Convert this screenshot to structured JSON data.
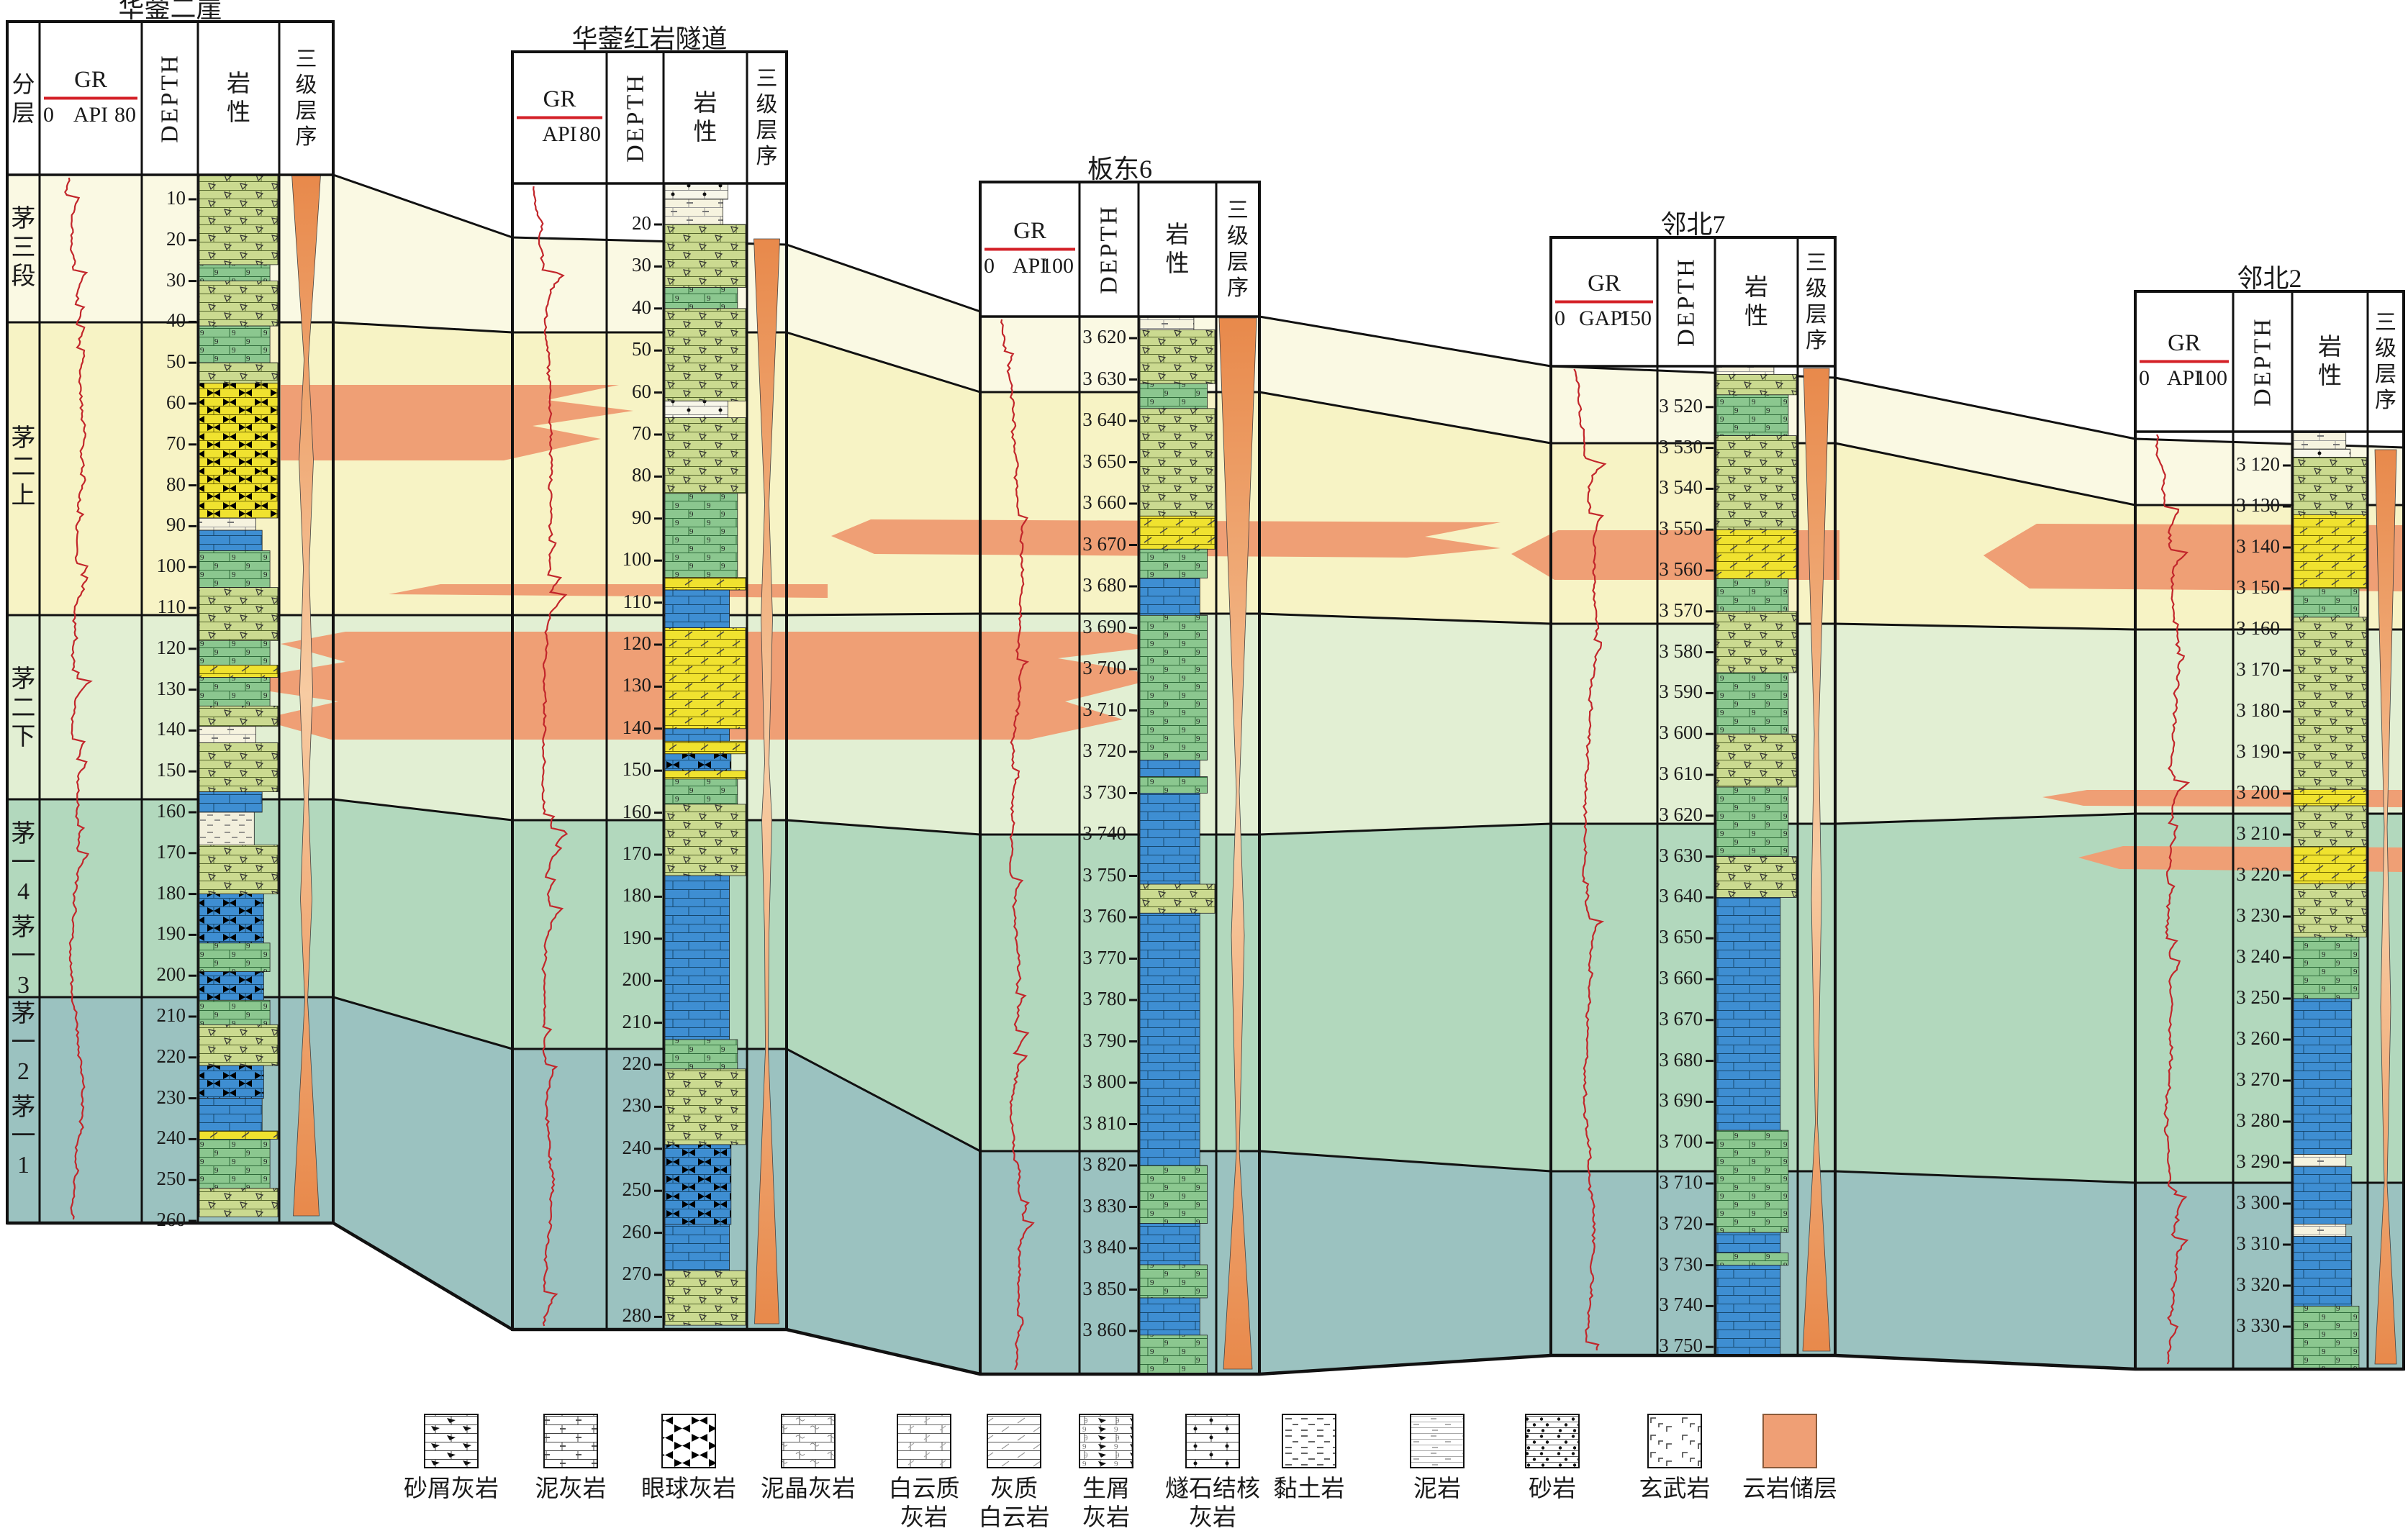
{
  "section": {
    "wells": [
      {
        "title": "华蓥二崖",
        "fenceng_label": "分层",
        "gr": {
          "label": "GR",
          "min": "0",
          "unit": "API",
          "max": "80"
        },
        "depth_label": "DEPTH",
        "lith_label": "岩性",
        "seq_label": "三级层序",
        "ticks": [
          "10",
          "20",
          "30",
          "40",
          "50",
          "60",
          "70",
          "80",
          "90",
          "100",
          "110",
          "120",
          "130",
          "140",
          "150",
          "160",
          "170",
          "180",
          "190",
          "200",
          "210",
          "220",
          "230",
          "240",
          "250",
          "260"
        ],
        "lithology": [
          [
            4,
            26,
            "bs"
          ],
          [
            26,
            30,
            "bn"
          ],
          [
            30,
            41,
            "bs"
          ],
          [
            41,
            50,
            "bn"
          ],
          [
            50,
            55,
            "bs"
          ],
          [
            55,
            88,
            "ey"
          ],
          [
            88,
            91,
            "ma"
          ],
          [
            91,
            96,
            "ls"
          ],
          [
            96,
            105,
            "bn"
          ],
          [
            105,
            118,
            "bs"
          ],
          [
            118,
            124,
            "bn"
          ],
          [
            124,
            127,
            "do"
          ],
          [
            127,
            134,
            "bn"
          ],
          [
            134,
            139,
            "bs"
          ],
          [
            139,
            143,
            "ma"
          ],
          [
            143,
            155,
            "bs"
          ],
          [
            155,
            160,
            "ls"
          ],
          [
            160,
            168,
            "cl"
          ],
          [
            168,
            180,
            "bs"
          ],
          [
            180,
            192,
            "eb"
          ],
          [
            192,
            199,
            "bn"
          ],
          [
            199,
            206,
            "eb"
          ],
          [
            206,
            212,
            "bn"
          ],
          [
            212,
            222,
            "bs"
          ],
          [
            222,
            230,
            "eb"
          ],
          [
            230,
            238,
            "ls"
          ],
          [
            238,
            240,
            "do"
          ],
          [
            240,
            252,
            "bn"
          ],
          [
            252,
            259,
            "bs"
          ]
        ]
      },
      {
        "title": "华蓥红岩隧道",
        "gr": {
          "label": "GR",
          "min": "",
          "unit": "API",
          "max": "80"
        },
        "depth_label": "DEPTH",
        "lith_label": "岩性",
        "seq_label": "三级层序",
        "ticks": [
          "20",
          "30",
          "40",
          "50",
          "60",
          "70",
          "80",
          "90",
          "100",
          "110",
          "120",
          "130",
          "140",
          "150",
          "160",
          "170",
          "180",
          "190",
          "200",
          "210",
          "220",
          "230",
          "240",
          "250",
          "260",
          "270",
          "280"
        ],
        "lithology": [
          [
            10,
            14,
            "ch"
          ],
          [
            14,
            20,
            "ma"
          ],
          [
            20,
            35,
            "bs"
          ],
          [
            35,
            40,
            "bn"
          ],
          [
            40,
            62,
            "bs"
          ],
          [
            62,
            66,
            "ch"
          ],
          [
            66,
            84,
            "bs"
          ],
          [
            84,
            104,
            "bn"
          ],
          [
            104,
            107,
            "do"
          ],
          [
            107,
            116,
            "ls"
          ],
          [
            116,
            140,
            "do"
          ],
          [
            140,
            143,
            "ls"
          ],
          [
            143,
            146,
            "do"
          ],
          [
            146,
            150,
            "eb"
          ],
          [
            150,
            152,
            "do"
          ],
          [
            152,
            158,
            "bn"
          ],
          [
            158,
            175,
            "bs"
          ],
          [
            175,
            214,
            "ls"
          ],
          [
            214,
            221,
            "bn"
          ],
          [
            221,
            239,
            "bs"
          ],
          [
            239,
            258,
            "eb"
          ],
          [
            258,
            269,
            "ls"
          ],
          [
            269,
            282,
            "bs"
          ]
        ]
      },
      {
        "title": "板东6",
        "gr": {
          "label": "GR",
          "min": "0",
          "unit": "API",
          "max": "100"
        },
        "depth_label": "DEPTH",
        "lith_label": "岩性",
        "seq_label": "三级层序",
        "ticks": [
          "3 620",
          "3 630",
          "3 640",
          "3 650",
          "3 660",
          "3 670",
          "3 680",
          "3 690",
          "3 700",
          "3 710",
          "3 720",
          "3 730",
          "3 740",
          "3 750",
          "3 760",
          "3 770",
          "3 780",
          "3 790",
          "3 800",
          "3 810",
          "3 820",
          "3 830",
          "3 840",
          "3 850",
          "3 860",
          "3 870"
        ],
        "lithology": [
          [
            3615,
            3618,
            "ma"
          ],
          [
            3618,
            3631,
            "bs"
          ],
          [
            3631,
            3637,
            "bn"
          ],
          [
            3637,
            3663,
            "bs"
          ],
          [
            3663,
            3671,
            "do"
          ],
          [
            3671,
            3678,
            "bn"
          ],
          [
            3678,
            3687,
            "ls"
          ],
          [
            3687,
            3722,
            "bn"
          ],
          [
            3722,
            3726,
            "ls"
          ],
          [
            3726,
            3730,
            "bn"
          ],
          [
            3730,
            3752,
            "ls"
          ],
          [
            3752,
            3759,
            "bs"
          ],
          [
            3759,
            3820,
            "ls"
          ],
          [
            3820,
            3834,
            "bn"
          ],
          [
            3834,
            3844,
            "ls"
          ],
          [
            3844,
            3852,
            "bn"
          ],
          [
            3852,
            3861,
            "ls"
          ],
          [
            3861,
            3871,
            "bn"
          ]
        ]
      },
      {
        "title": "邻北7",
        "gr": {
          "label": "GR",
          "min": "0",
          "unit": "GAPI",
          "max": "150"
        },
        "depth_label": "DEPTH",
        "lith_label": "岩性",
        "seq_label": "三级层序",
        "ticks": [
          "3 510",
          "3 520",
          "3 530",
          "3 540",
          "3 550",
          "3 560",
          "3 570",
          "3 580",
          "3 590",
          "3 600",
          "3 610",
          "3 620",
          "3 630",
          "3 640",
          "3 650",
          "3 660",
          "3 670",
          "3 680",
          "3 690",
          "3 700",
          "3 710",
          "3 720",
          "3 730",
          "3 740",
          "3 750"
        ],
        "lithology": [
          [
            3510,
            3512,
            "ma"
          ],
          [
            3512,
            3517,
            "bs"
          ],
          [
            3517,
            3527,
            "bn"
          ],
          [
            3527,
            3550,
            "bs"
          ],
          [
            3550,
            3562,
            "do"
          ],
          [
            3562,
            3570,
            "bn"
          ],
          [
            3570,
            3585,
            "bs"
          ],
          [
            3585,
            3600,
            "bn"
          ],
          [
            3600,
            3613,
            "bs"
          ],
          [
            3613,
            3630,
            "bn"
          ],
          [
            3630,
            3640,
            "bs"
          ],
          [
            3640,
            3697,
            "ls"
          ],
          [
            3697,
            3722,
            "bn"
          ],
          [
            3722,
            3727,
            "ls"
          ],
          [
            3727,
            3730,
            "bn"
          ],
          [
            3730,
            3752,
            "ls"
          ]
        ]
      },
      {
        "title": "邻北2",
        "gr": {
          "label": "GR",
          "min": "0",
          "unit": "API",
          "max": "100"
        },
        "depth_label": "DEPTH",
        "lith_label": "岩性",
        "seq_label": "三级层序",
        "ticks": [
          "3 120",
          "3 130",
          "3 140",
          "3 150",
          "3 160",
          "3 170",
          "3 180",
          "3 190",
          "3 200",
          "3 210",
          "3 220",
          "3 230",
          "3 240",
          "3 250",
          "3 260",
          "3 270",
          "3 280",
          "3 290",
          "3 300",
          "3 310",
          "3 320",
          "3 330",
          "3 340"
        ],
        "lithology": [
          [
            3112,
            3116,
            "ma"
          ],
          [
            3116,
            3118,
            "ch"
          ],
          [
            3118,
            3132,
            "bs"
          ],
          [
            3132,
            3150,
            "do"
          ],
          [
            3150,
            3157,
            "bn"
          ],
          [
            3157,
            3199,
            "bs"
          ],
          [
            3199,
            3203,
            "do"
          ],
          [
            3203,
            3213,
            "bs"
          ],
          [
            3213,
            3222,
            "do"
          ],
          [
            3222,
            3235,
            "bs"
          ],
          [
            3235,
            3250,
            "bn"
          ],
          [
            3250,
            3288,
            "ls"
          ],
          [
            3288,
            3291,
            "ma"
          ],
          [
            3291,
            3305,
            "ls"
          ],
          [
            3305,
            3308,
            "ma"
          ],
          [
            3308,
            3325,
            "ls"
          ],
          [
            3325,
            3341,
            "bn"
          ]
        ]
      }
    ],
    "fenceng_zones": [
      {
        "label": "茅三段"
      },
      {
        "label": "茅二上"
      },
      {
        "label": "茅二下"
      },
      {
        "label": "茅一4"
      },
      {
        "label": "茅一3"
      },
      {
        "label": "茅一2"
      },
      {
        "label": "茅一1"
      }
    ],
    "legend": [
      {
        "label": "砂屑灰岩",
        "pattern": "sandclast"
      },
      {
        "label": "泥灰岩",
        "pattern": "marl"
      },
      {
        "label": "眼球灰岩",
        "pattern": "eyeball"
      },
      {
        "label": "泥晶灰岩",
        "pattern": "micrite"
      },
      {
        "label": "白云质\n灰岩",
        "pattern": "dololime"
      },
      {
        "label": "灰质\n白云岩",
        "pattern": "limydolo"
      },
      {
        "label": "生屑\n灰岩",
        "pattern": "bioclast"
      },
      {
        "label": "燧石结核\n灰岩",
        "pattern": "chert"
      },
      {
        "label": "黏土岩",
        "pattern": "clay"
      },
      {
        "label": "泥岩",
        "pattern": "mud"
      },
      {
        "label": "砂岩",
        "pattern": "sand"
      },
      {
        "label": "玄武岩",
        "pattern": "basalt"
      },
      {
        "label": "云岩储层",
        "pattern": "reservoir"
      }
    ],
    "colors": {
      "zone_m3": "#FAF9E3",
      "zone_m2_upper": "#F7F3C5",
      "zone_m2_lower": "#E2EFD3",
      "zone_m1_upper": "#B2D8BD",
      "zone_m1_lower": "#9BC2C0",
      "reservoir": "#EF9F75",
      "gr_curve": "#C2262B",
      "scale_line": "#D42027",
      "lith_olive": "#CBDA90",
      "lith_green": "#8BC78F",
      "lith_yellow": "#F0E22F",
      "lith_blue": "#3E8ED2",
      "line": "#111111"
    }
  }
}
